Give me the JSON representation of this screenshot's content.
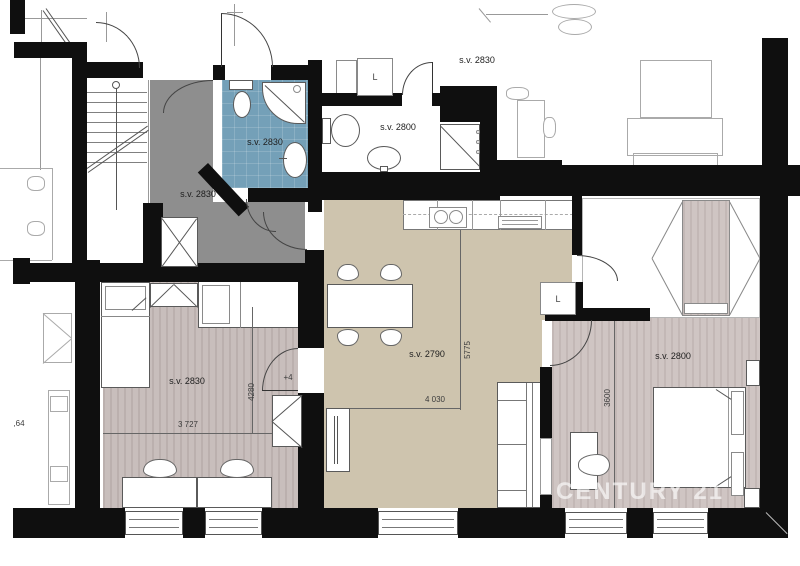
{
  "rooms": {
    "hall": {
      "label": "s.v. 2830"
    },
    "bathroom_1": {
      "label": "s.v. 2830"
    },
    "bathroom_2": {
      "label": "s.v. 2800"
    },
    "corridor": {
      "label": "s.v. 2830"
    },
    "living_kitchen": {
      "label": "s.v. 2790",
      "width_dim": "4 030",
      "height_dim": "5775"
    },
    "bedroom_left": {
      "label": "s.v. 2830",
      "width_dim": "3 727",
      "height_dim": "4280",
      "floor_level": "+4"
    },
    "bedroom_right": {
      "label": "s.v. 2800",
      "height_dim": "3600"
    },
    "neighbor_left": {
      "partial_dim": ",64"
    }
  },
  "appliances": {
    "utility_closet_hall": "L",
    "utility_closet_living": "L"
  },
  "watermark": {
    "text": "CENTURY 21",
    "color": "rgba(255,255,255,0.62)"
  },
  "colors": {
    "wall": "#0f0f0f",
    "hall_floor": "#8e8e8e",
    "bathroom_floor": "#74a0b8",
    "living_floor": "#cec4ae",
    "bedroom_left_floor": "#c8bebc",
    "bedroom_right_floor": "#cfc5c3"
  }
}
